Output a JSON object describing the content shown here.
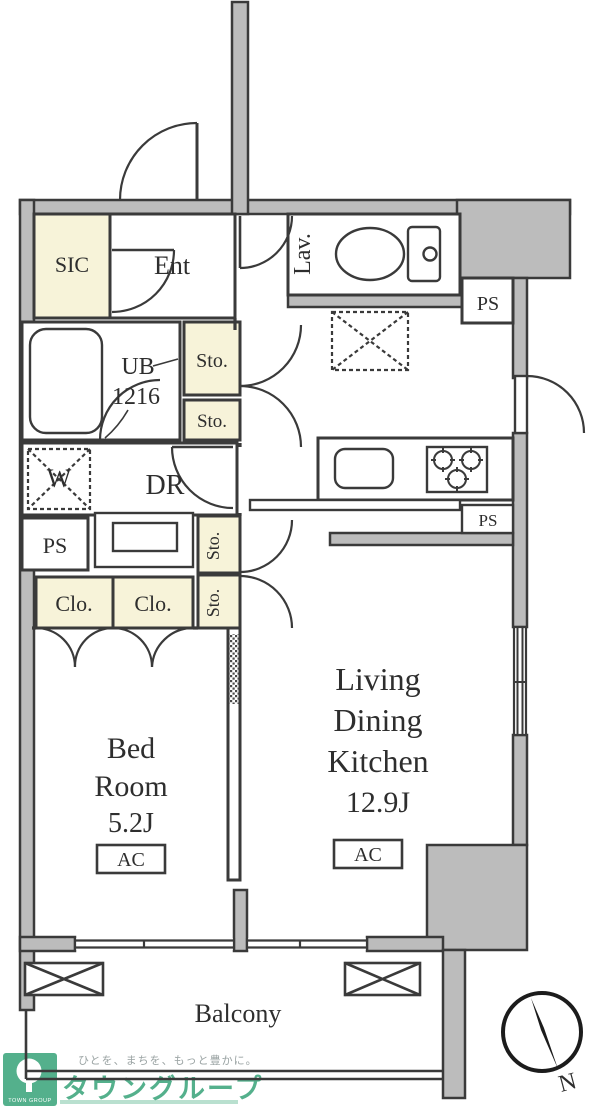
{
  "document": {
    "type": "apartment-floor-plan"
  },
  "labels": {
    "sic": "SIC",
    "ent": "Ent",
    "lav": "Lav.",
    "ps": "PS",
    "sto": "Sto.",
    "ub": "UB",
    "ub_size": "1216",
    "w": "W",
    "dr": "DR",
    "clo": "Clo.",
    "bed_line1": "Bed",
    "bed_line2": "Room",
    "bed_size": "5.2J",
    "ac": "AC",
    "ldk_line1": "Living",
    "ldk_line2": "Dining",
    "ldk_line3": "Kitchen",
    "ldk_size": "12.9J",
    "balcony": "Balcony",
    "compass_north": "N"
  },
  "branding": {
    "tagline": "ひとを、まちを、もっと豊かに。",
    "company": "タウングループ",
    "logo_caption": "TOWN GROUP"
  },
  "colors": {
    "wall_fill": "#bcbcbc",
    "outline": "#3a3a3a",
    "closet_fill": "#f7f3d9",
    "brand_green": "#54b08c",
    "tagline_gray": "#9aa3a3"
  }
}
